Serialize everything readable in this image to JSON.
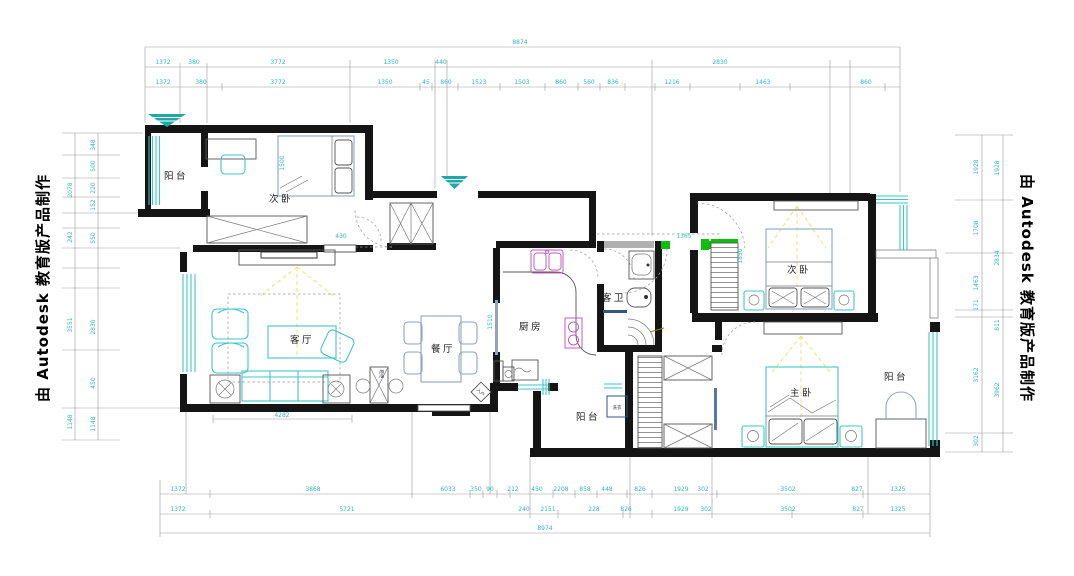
{
  "watermark": {
    "left": "由 Autodesk 教育版产品制作",
    "right": "由 Autodesk 教育版产品制作"
  },
  "rooms": {
    "balcony_tl": "阳台",
    "bedroom_tl": "次卧",
    "living": "客厅",
    "dining": "餐厅",
    "kitchen": "厨房",
    "guest_bath": "客卫",
    "bedroom_tr": "次卧",
    "master": "主卧",
    "balcony_right": "阳台",
    "balcony_mid": "阳台",
    "washer": "洗衣",
    "shoe_cabinet": "鞋柜",
    "entry_diamond": "入户"
  },
  "colors": {
    "wall": "#151515",
    "window_cyan": "#3FC6C6",
    "furniture_blue": "#8CA6C0",
    "fixture_magenta": "#C05CC0",
    "marker_green": "#0CBF0C",
    "light_ray_yellow": "#E6E677",
    "entry_marker_teal": "#1FA8A8",
    "dimension_text_cyan": "#2FB8B8",
    "tile_navy": "#33557F"
  },
  "dims": {
    "top_total": "8874",
    "top_row1": [
      "1372",
      "380",
      "3772",
      "1350",
      "440",
      "2830"
    ],
    "top_row2": [
      "1372",
      "380",
      "3772",
      "1350",
      "45",
      "860",
      "1523",
      "1503",
      "860",
      "560",
      "836",
      "1216",
      "1463",
      "860"
    ],
    "bottom_row1": [
      "1372",
      "3868",
      "6033",
      "350",
      "90",
      "212",
      "450",
      "2208",
      "858",
      "448",
      "826",
      "1929",
      "302",
      "3502",
      "827",
      "1325"
    ],
    "bottom_row2": [
      "1372",
      "5721",
      "240",
      "2151",
      "228",
      "826",
      "1929",
      "302",
      "3502",
      "827",
      "1325"
    ],
    "bottom_total": "8974",
    "left_outer": [
      "2078",
      "242",
      "3551",
      "1148"
    ],
    "left_inner": [
      "348",
      "500",
      "220",
      "152",
      "550",
      "2830",
      "450",
      "1148"
    ],
    "right_inner": [
      "1928",
      "1708",
      "1463",
      "171",
      "3162",
      "302"
    ],
    "right_outer": [
      "1928",
      "2834",
      "811",
      "3962"
    ],
    "living_width": "4282",
    "kitchen_w": "1510",
    "corridor_w": "1365",
    "bed2_door": "430",
    "bed_tl": "1500",
    "wardrobe_tr": "1850"
  }
}
